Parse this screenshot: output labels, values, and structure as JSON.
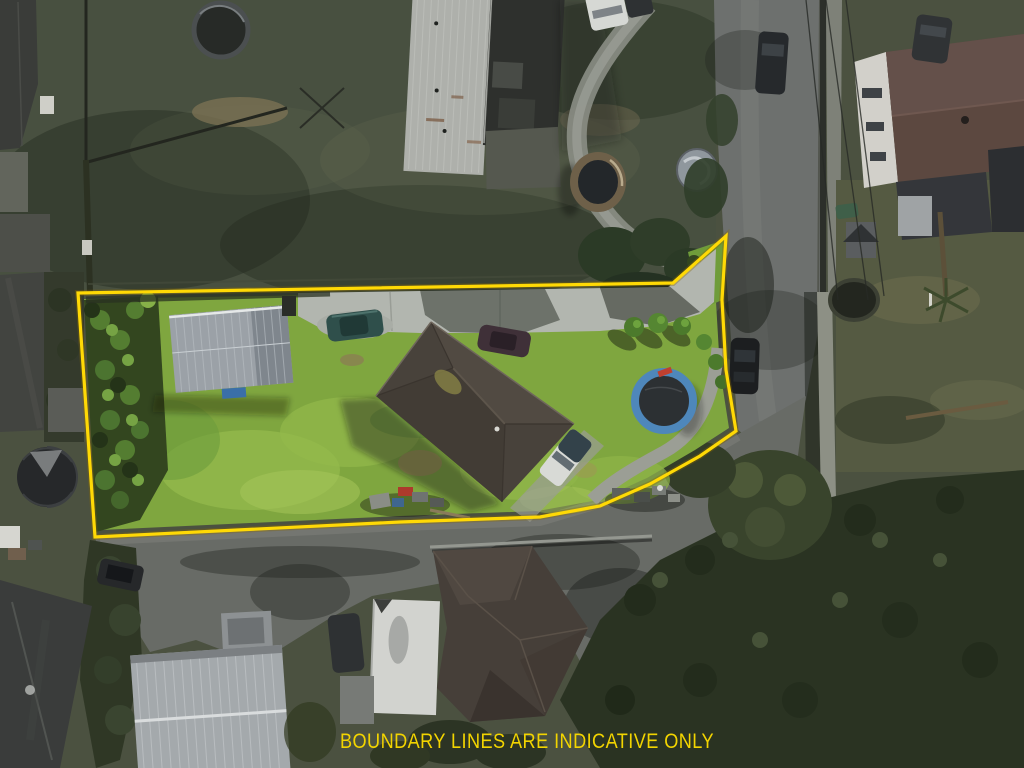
{
  "overlay": {
    "disclaimer": "BOUNDARY LINES ARE INDICATIVE ONLY",
    "boundary_color": "#ffd905",
    "disclaimer_color": "#f2d400"
  },
  "palette": {
    "sunlit_lawn": "#7fa63f",
    "neighbor_lawn": "#4b5140",
    "asphalt_road": "#6d706e",
    "concrete_driveway": "#b2b6af",
    "main_house_roof": "#48423b",
    "garage_shed_roof": "#9ba1a7",
    "tree_canopy": "#2a3322",
    "trampoline_ring": "#4e87bb"
  },
  "features": [
    "property-boundary",
    "main-house",
    "garage-shed",
    "garden-strip",
    "front-driveway",
    "blue-trampoline",
    "parked-cars",
    "right-road",
    "shared-driveway",
    "neighbor-houses",
    "tree-masses"
  ]
}
